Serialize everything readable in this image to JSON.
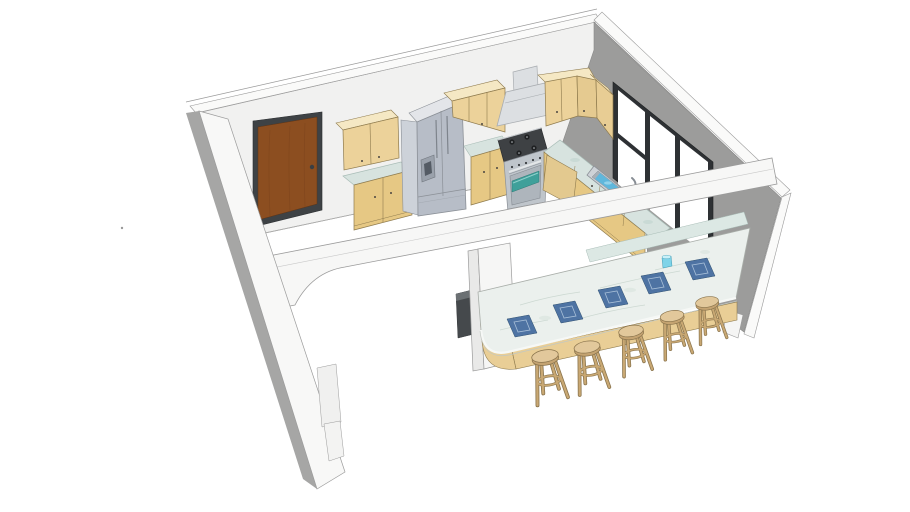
{
  "viewport": {
    "width": 910,
    "height": 512,
    "background_color": "#FFFFFF",
    "description": "3D model preview of an L-shaped kitchen with breakfast bar and stools"
  },
  "scene": {
    "room": {
      "walls": [
        "back wall with entry door",
        "right wall with sliding window",
        "front wall with arched pass-through",
        "left wall"
      ],
      "floor": "white"
    },
    "objects": [
      "entry door",
      "upper wall cabinets",
      "base cabinets with marble countertop",
      "french-door refrigerator with dispenser",
      "range hood",
      "stainless gas range with oven",
      "kitchen sink with faucet",
      "window with three panes",
      "peninsula counter",
      "breakfast bar with wood base and marble top",
      "bar stools",
      "blue woven placemats",
      "blue cup",
      "trash bin"
    ],
    "counts": {
      "bar_stools": 5,
      "placemats": 5,
      "window_panes": 3,
      "upper_cabinet_sections": 4
    }
  },
  "colors": {
    "background": "#FFFFFF",
    "back_wall": "#F1F1F0",
    "left_wall": "#F8F8F7",
    "wall_shadow": "#A6A6A5",
    "right_wall": "#9C9C9B",
    "wall_trim": "#FAFAF9",
    "arch_wall": "#F7F7F6",
    "outline": "#9B9B9B",
    "door_wood": "#8C4E20",
    "door_frame": "#3E4245",
    "cabinet_wood": "#ECD29A",
    "cabinet_base_wood": "#E6C884",
    "cabinet_top": "#F5E8C4",
    "counter_marble": "#D7E3DF",
    "peninsula_marble": "#DCE8E4",
    "bar_marble": "#EBF0ED",
    "bar_base_wood": "#E9CE96",
    "stainless_front": "#B7BDC7",
    "stainless_side": "#CDD2D9",
    "stainless_top": "#E3E5E9",
    "hood_steel": "#DCDFE2",
    "stove_steel": "#BFC5CB",
    "cooktop_dark": "#3E4144",
    "oven_glass": "#3FA09A",
    "window_frame": "#2E3134",
    "window_pane": "#FFFFFF",
    "sink_water": "#5FB7DC",
    "placemat_blue": "#4E73A3",
    "placemat_trim": "#A8BFD8",
    "cup_blue": "#7ED3E8",
    "stool_seat": "#E2C89B",
    "stool_leg": "#C9A873",
    "trash_bin": "#45494C"
  }
}
